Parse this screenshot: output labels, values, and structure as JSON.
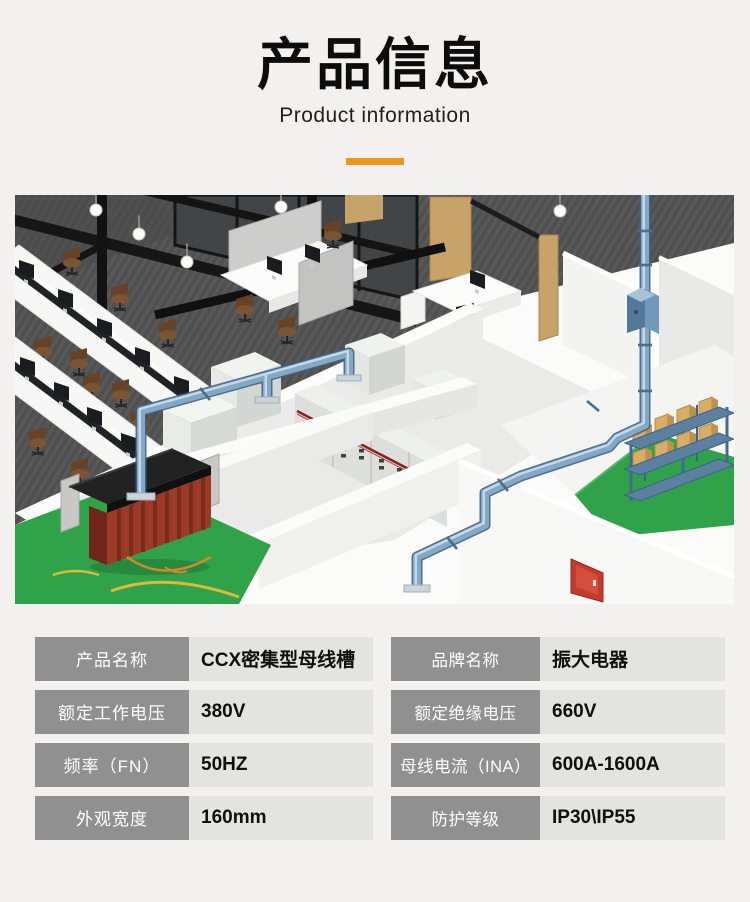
{
  "theme": {
    "page_bg": "#f2f1ef",
    "accent": "#f0941d",
    "title_text": "#0c0c0c",
    "label_bg": "#909090",
    "label_text": "#ffffff",
    "value_bg": "#e3e3e2",
    "value_text": "#0f0f0f",
    "busway_blue": "#84a9c6",
    "floor_green": "#2fa24a",
    "transformer_red": "#9c3a28",
    "carpet_gray": "#565656"
  },
  "header": {
    "title": "产品信息",
    "subtitle": "Product information"
  },
  "spec_table": {
    "columns": [
      {
        "rows": [
          {
            "label": "产品名称",
            "value": "CCX密集型母线槽"
          },
          {
            "label": "额定工作电压",
            "value": "380V"
          },
          {
            "label": "频率（FN）",
            "value": "50HZ"
          },
          {
            "label": "外观宽度",
            "value": "160mm"
          }
        ]
      },
      {
        "rows": [
          {
            "label": "品牌名称",
            "value": "振大电器"
          },
          {
            "label": "额定绝缘电压",
            "value": "660V"
          },
          {
            "label": "母线电流（INA）",
            "value": "600A-1600A"
          },
          {
            "label": "防护等级",
            "value": "IP30\\IP55"
          }
        ]
      }
    ]
  }
}
